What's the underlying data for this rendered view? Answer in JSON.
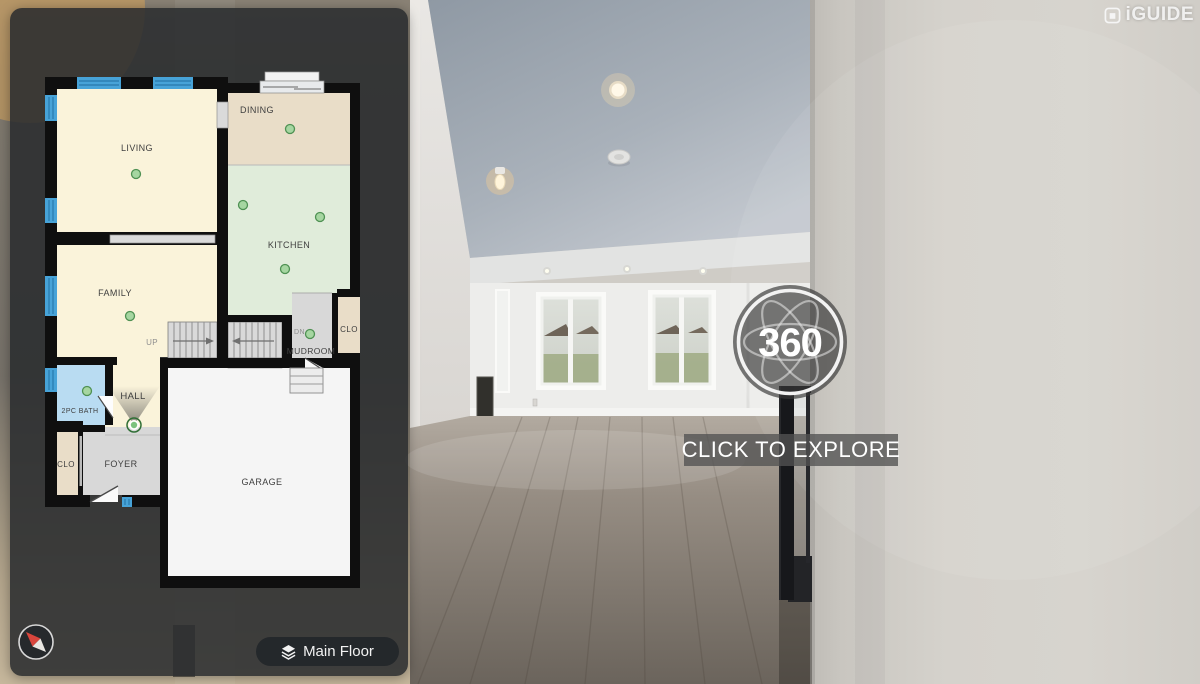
{
  "header": {
    "logo_text": "iGUIDE"
  },
  "pano_badge": {
    "label": "360",
    "cta_label": "CLICK TO EXPLORE"
  },
  "controls": {
    "floor_selector_label": "Main Floor"
  },
  "floorplan": {
    "floor_name": "Main Floor",
    "rooms": {
      "living": "LIVING",
      "dining": "DINING",
      "kitchen": "KITCHEN",
      "family": "FAMILY",
      "mudroom": "MUDROOM",
      "closet_right": "CLO",
      "bath": "2PC BATH",
      "hall": "HALL",
      "foyer": "FOYER",
      "closet_left": "CLO",
      "garage": "GARAGE"
    },
    "stairs": {
      "up_label": "UP",
      "down_label": "DN"
    },
    "panorama_marker_count": 9,
    "colors": {
      "wall": "#0f0f0f",
      "room_cream": "#faf3da",
      "room_tan": "#e9ddc8",
      "room_green": "#e0ecda",
      "room_gray": "#d8d8d8",
      "room_blue": "#b9dcf2",
      "room_white": "#f5f5f5",
      "window_blue": "#47a3d8",
      "marker_green": "#a6d6a1",
      "marker_stroke": "#4f9153",
      "panel_bg": "rgba(41,44,46,0.87)"
    }
  }
}
